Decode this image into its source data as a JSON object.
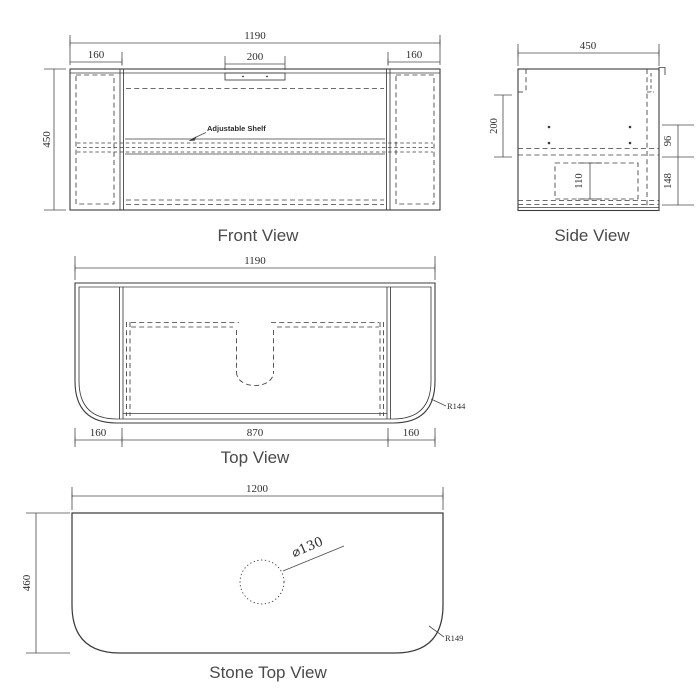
{
  "drawing": {
    "front_view": {
      "title": "Front View",
      "dim_overall_width": "1190",
      "dim_left_panel_width": "160",
      "dim_handle_width": "200",
      "dim_right_panel_width": "160",
      "dim_height": "450",
      "shelf_label": "Adjustable Shelf"
    },
    "side_view": {
      "title": "Side View",
      "dim_depth": "450",
      "dim_rail_to_shelf": "200",
      "dim_shelf_gap": "96",
      "dim_shelf_to_bottom": "148",
      "dim_recess_height": "110"
    },
    "top_view": {
      "title": "Top View",
      "dim_overall_width": "1190",
      "dim_left_panel_width": "160",
      "dim_inner_width": "870",
      "dim_right_panel_width": "160",
      "corner_radius": "R144"
    },
    "stone_top_view": {
      "title": "Stone Top View",
      "dim_width": "1200",
      "dim_depth": "460",
      "hole_diameter": "⌀130",
      "corner_radius": "R149"
    }
  },
  "colors": {
    "background": "#ffffff",
    "object_line": "#3c3c3c",
    "dimension_line": "#4a4a4a",
    "text": "#2e2e2e"
  }
}
